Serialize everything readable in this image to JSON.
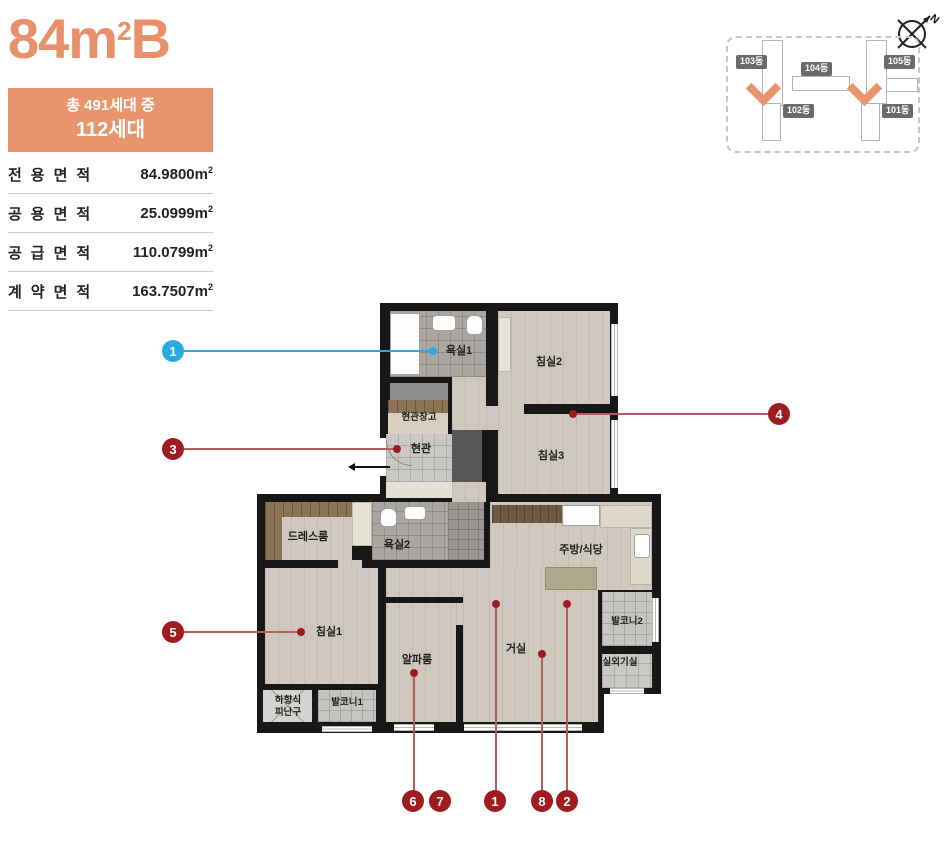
{
  "header": {
    "title_base": "84m",
    "title_sup": "2",
    "title_suffix": "B"
  },
  "badge": {
    "line1": "총 491세대 중",
    "line2": "112세대"
  },
  "area_table": {
    "rows": [
      {
        "label": "전용면적",
        "value": "84.9800"
      },
      {
        "label": "공용면적",
        "value": "25.0999"
      },
      {
        "label": "공급면적",
        "value": "110.0799"
      },
      {
        "label": "계약면적",
        "value": "163.7507"
      }
    ],
    "unit": "m",
    "unit_sup": "2"
  },
  "site_plan": {
    "compass_label": "N",
    "buildings": [
      {
        "label": "103동"
      },
      {
        "label": "104동"
      },
      {
        "label": "105동"
      },
      {
        "label": "102동"
      },
      {
        "label": "101동"
      }
    ]
  },
  "floorplan": {
    "rooms": [
      {
        "label": "욕실1"
      },
      {
        "label": "침실2"
      },
      {
        "label": "현관창고"
      },
      {
        "label": "현관"
      },
      {
        "label": "침실3"
      },
      {
        "label": "드레스룸"
      },
      {
        "label": "욕실2"
      },
      {
        "label": "주방/식당"
      },
      {
        "label": "침실1"
      },
      {
        "label": "알파룸"
      },
      {
        "label": "거실"
      },
      {
        "label": "발코니2"
      },
      {
        "label": "실외기실"
      },
      {
        "label": "하향식\n피난구"
      },
      {
        "label": "발코니1"
      }
    ]
  },
  "markers": {
    "side": [
      {
        "label": "1"
      },
      {
        "label": "3"
      },
      {
        "label": "4"
      },
      {
        "label": "5"
      }
    ],
    "bottom": [
      {
        "label": "6"
      },
      {
        "label": "7"
      },
      {
        "label": "1"
      },
      {
        "label": "8"
      },
      {
        "label": "2"
      }
    ]
  },
  "colors": {
    "accent_orange": "#E8946D",
    "marker_red": "#9E1C20",
    "marker_cyan": "#29ABE2",
    "wall_black": "#171717"
  }
}
